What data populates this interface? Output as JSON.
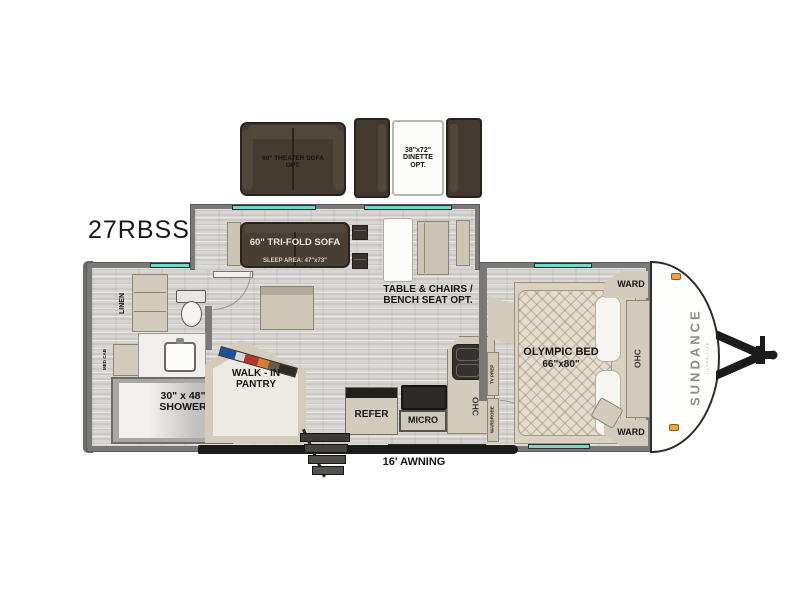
{
  "model": "27RBSS",
  "options": {
    "theater_sofa_line1": "60\" THEATER SOFA",
    "theater_sofa_line2": "OPT.",
    "dinette_line1": "38\"x72\"",
    "dinette_line2": "DINETTE",
    "dinette_line3": "OPT."
  },
  "slideout": {
    "trifold_line1": "60\" TRI-FOLD SOFA",
    "trifold_line2": "SLEEP AREA: 47\"x73\""
  },
  "living": {
    "table_opt_line1": "TABLE & CHAIRS /",
    "table_opt_line2": "BENCH SEAT OPT."
  },
  "bathroom": {
    "linen": "LINEN",
    "med_cab": "MED CAB",
    "shower_line1": "30\" x 48\"",
    "shower_line2": "SHOWER"
  },
  "kitchen": {
    "pantry_line1": "WALK - IN",
    "pantry_line2": "PANTRY",
    "refer": "REFER",
    "micro": "MICRO",
    "ohc": "OHC"
  },
  "bedroom": {
    "bed_line1": "OLYMPIC BED",
    "bed_line2": "66\"x80\"",
    "ward_front": "WARD",
    "ward_rear": "WARD",
    "ohc": "OHC",
    "tv_prep": "TV PREP",
    "wardrobe": "WARDROBE"
  },
  "exterior": {
    "awning": "16' AWNING",
    "brand": "SUNDANCE",
    "brand_sub": "ULTRA-LITE"
  },
  "colors": {
    "window_teal": "#74d6cc",
    "wall_gray": "#7b7977",
    "cabinet_tan": "#d3ccbc",
    "sofa_brown": "#483e34",
    "marker_light_orange": "#f2a23b"
  }
}
